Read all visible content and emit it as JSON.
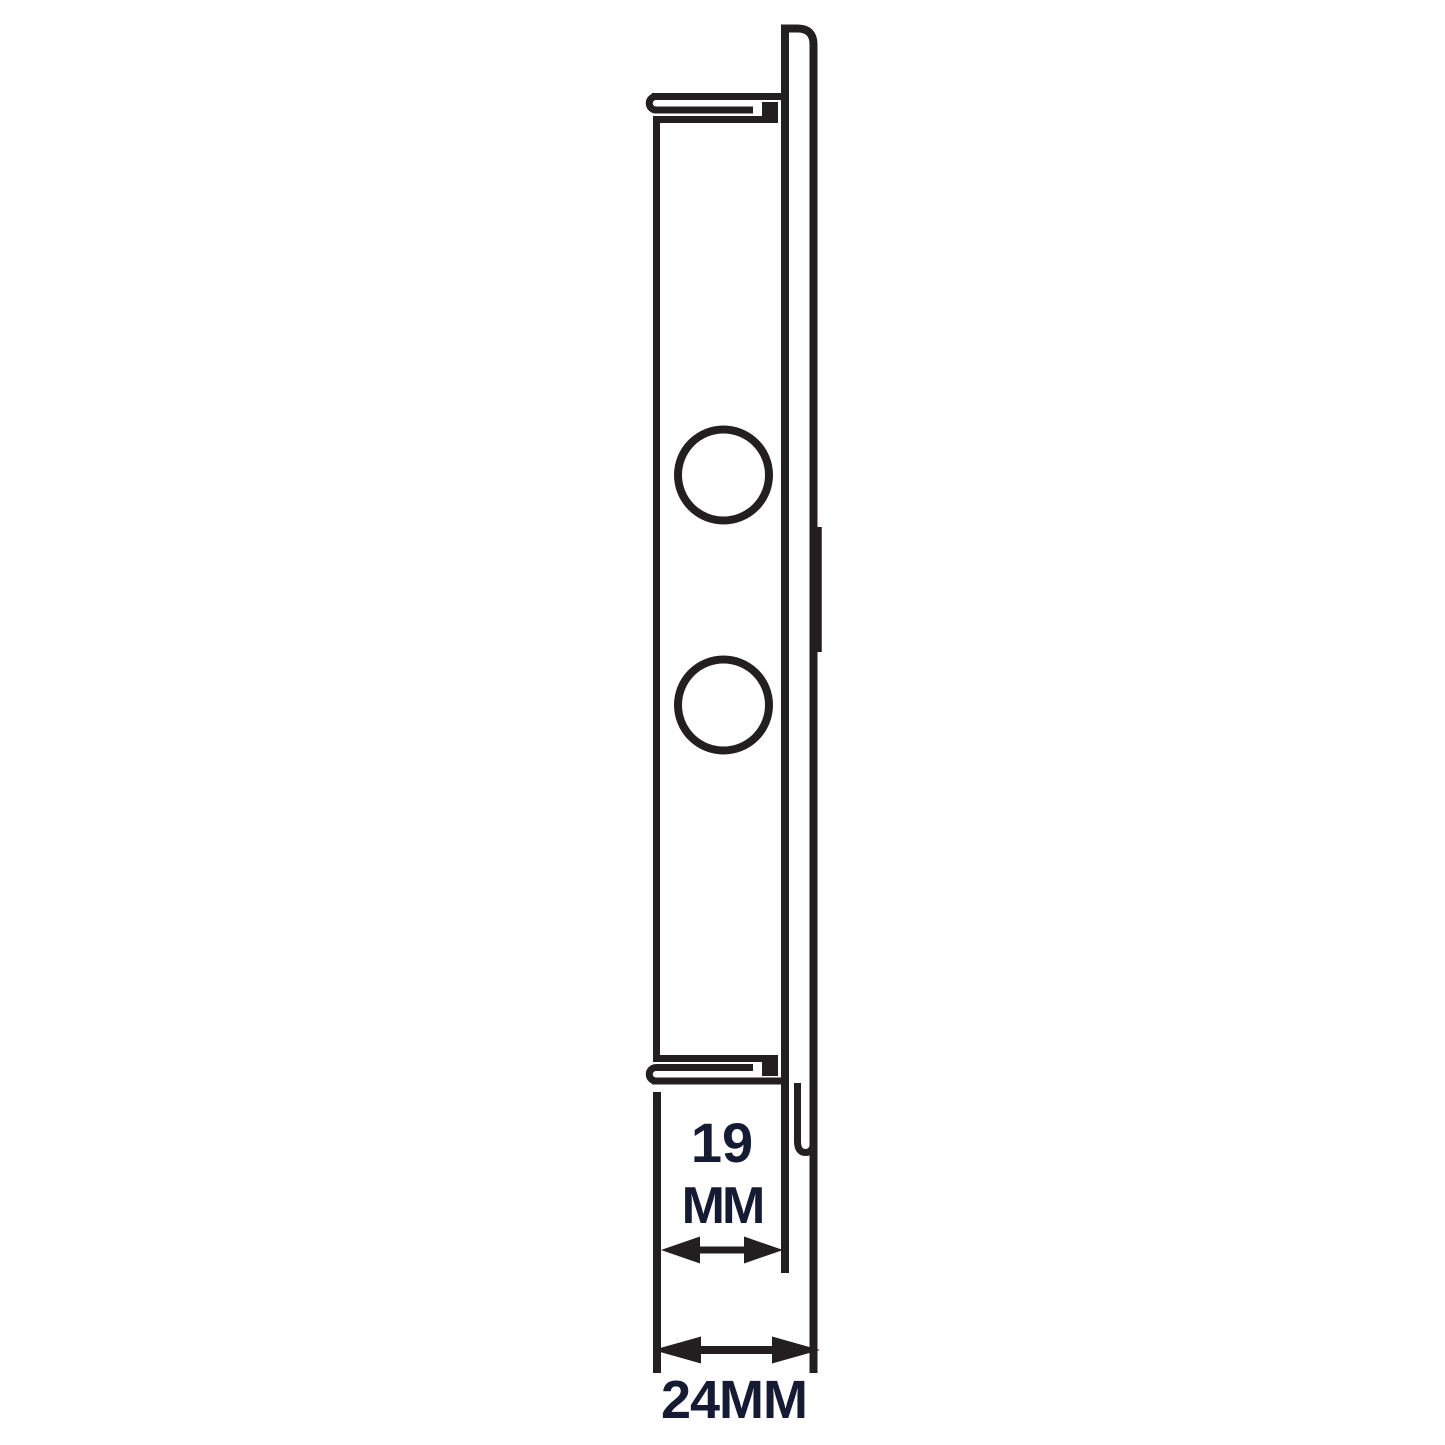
{
  "page": {
    "background": "#ffffff"
  },
  "drawing": {
    "name": "grille-side-profile-technical-drawing",
    "line_color": "#231f20",
    "label_color": "#151b33",
    "dimension_inner": {
      "value": "19",
      "unit": "MM"
    },
    "dimension_overall": {
      "label": "24MM"
    }
  }
}
